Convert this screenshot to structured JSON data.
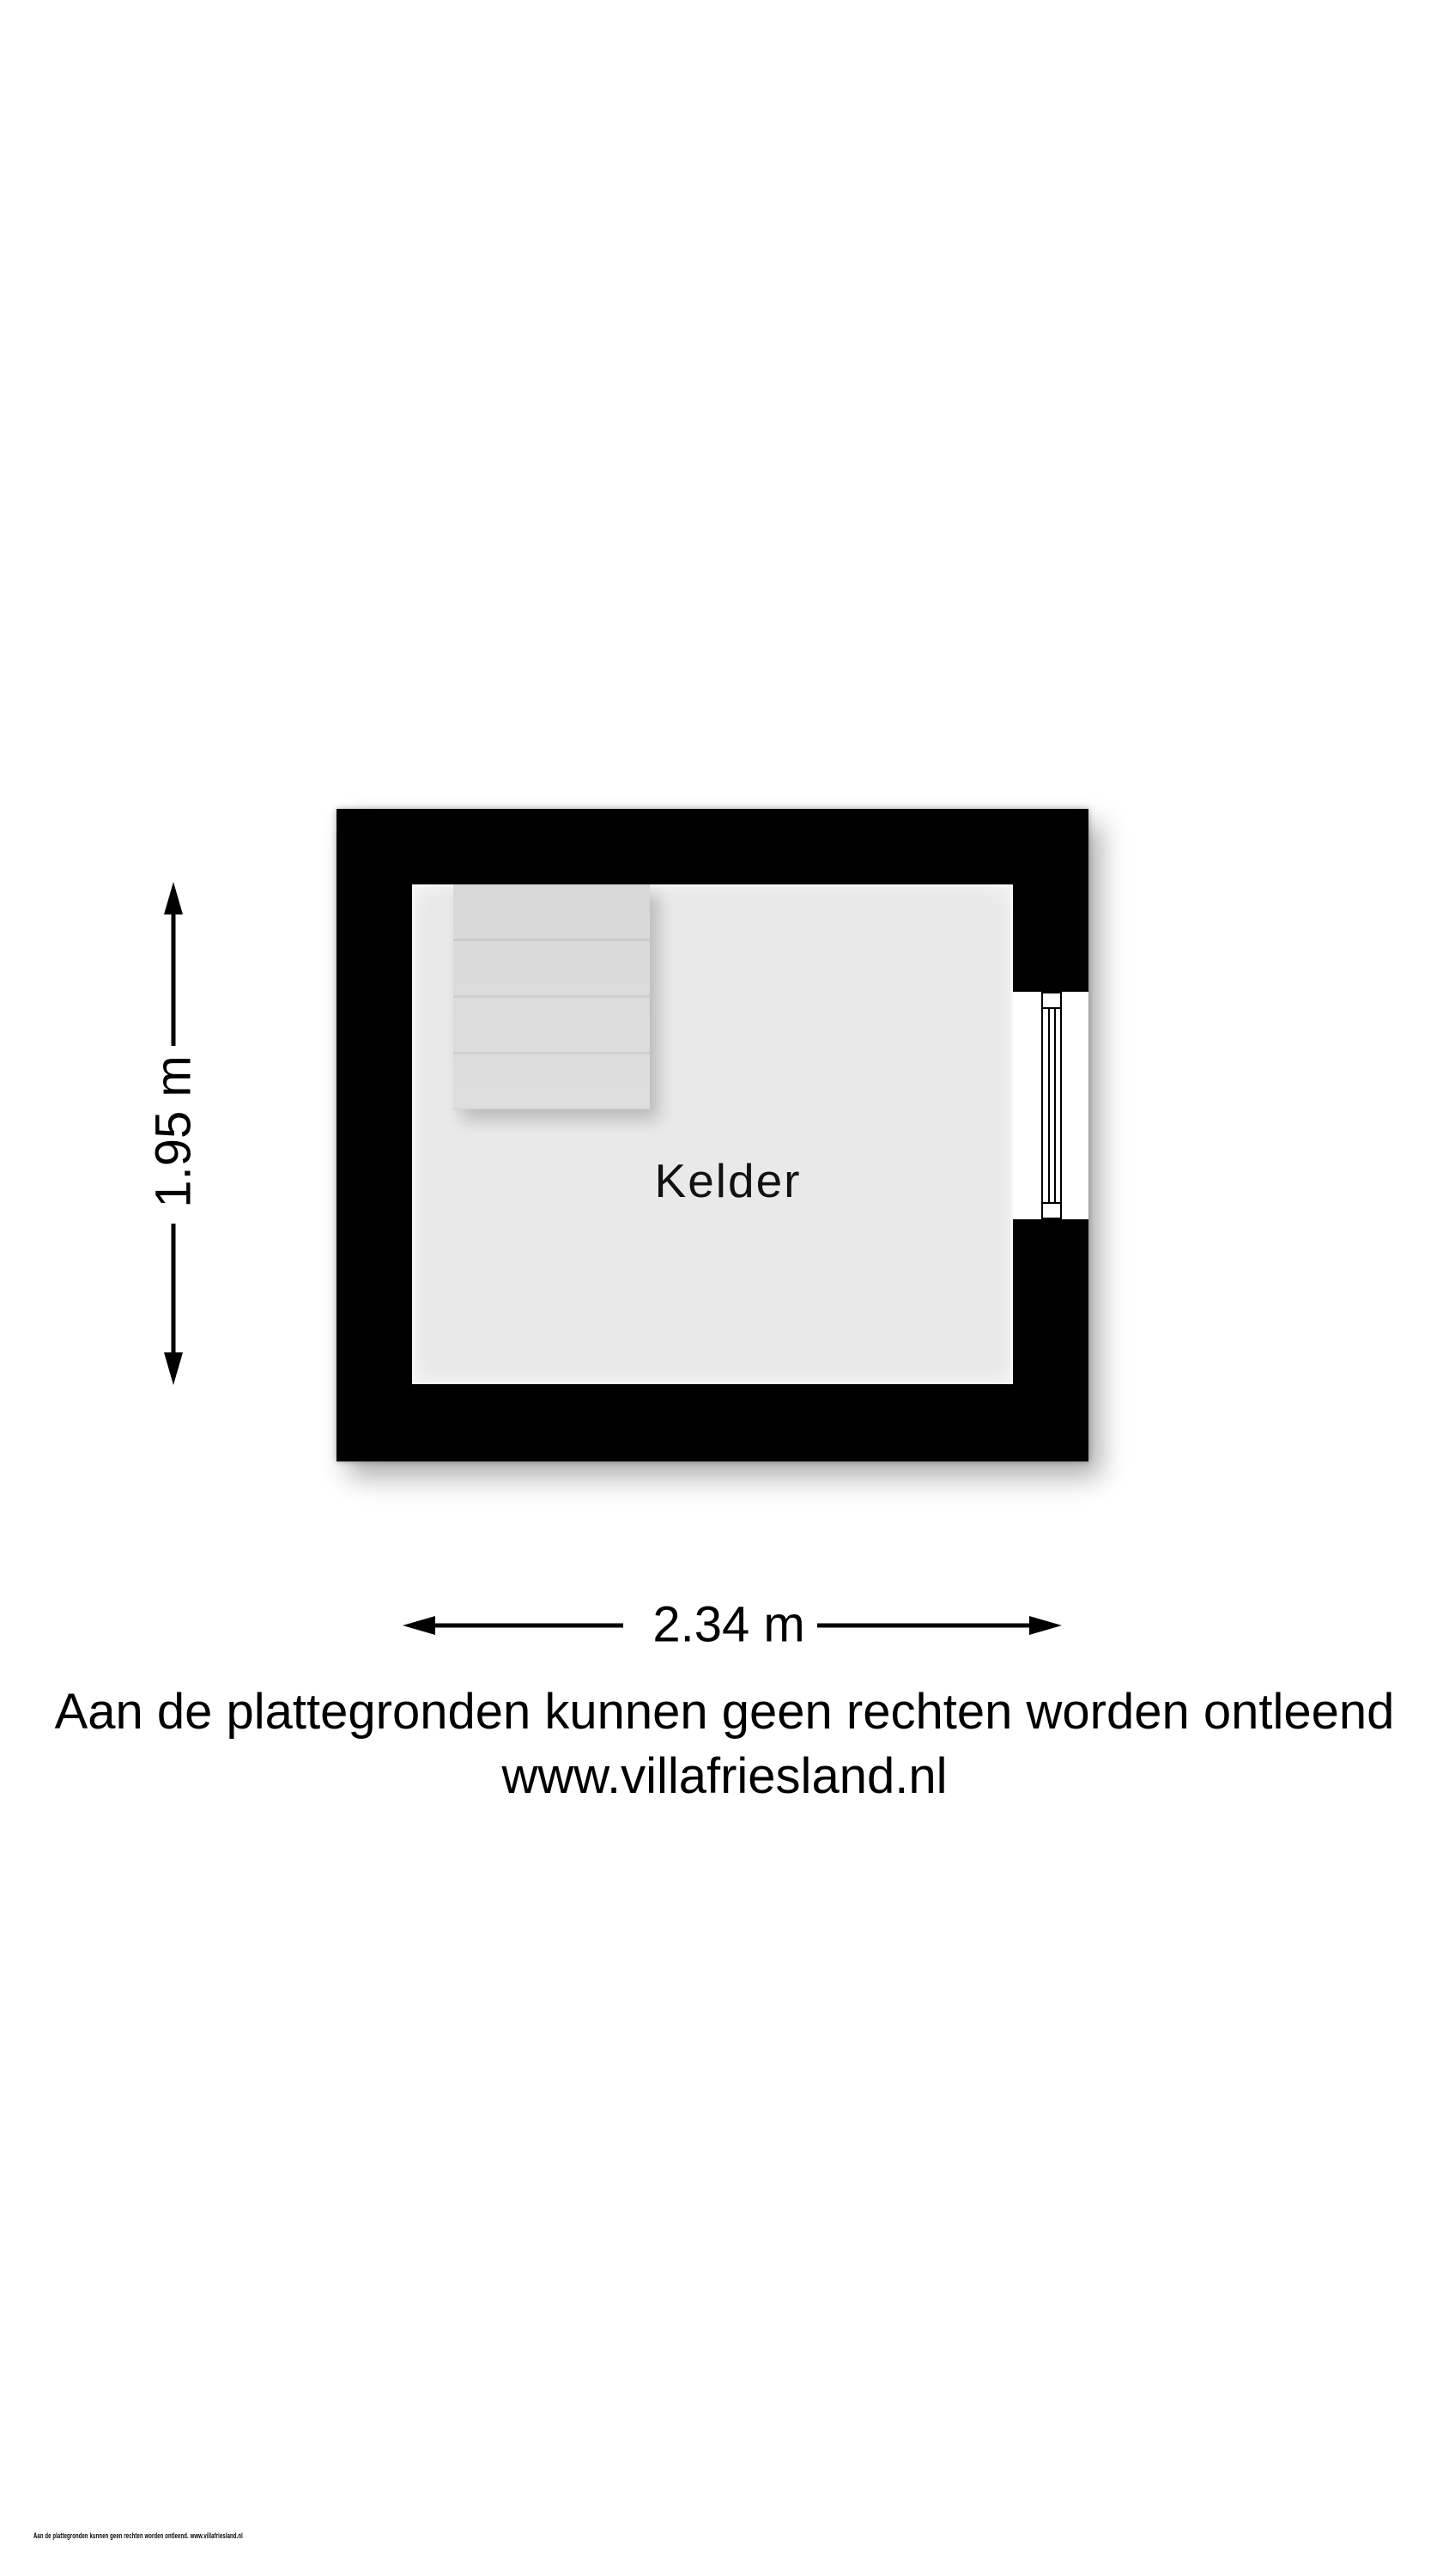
{
  "floorplan": {
    "room": {
      "label": "Kelder"
    },
    "dimensions": {
      "height": "1.95 m",
      "width": "2.34 m"
    },
    "features": {
      "stairs": "stairs",
      "window": "window"
    },
    "colors": {
      "wall": "#000000",
      "floor": "#e9e9e9",
      "stairs": "#dcdcdc",
      "page_background": "#ffffff",
      "text": "#000000"
    }
  },
  "disclaimer": {
    "line1": "Aan de plattegronden kunnen geen rechten worden ontleend",
    "line2": "www.villafriesland.nl"
  },
  "fineprint": "Aan de plattegronden kunnen geen rechten worden ontleend. www.villafriesland.nl"
}
